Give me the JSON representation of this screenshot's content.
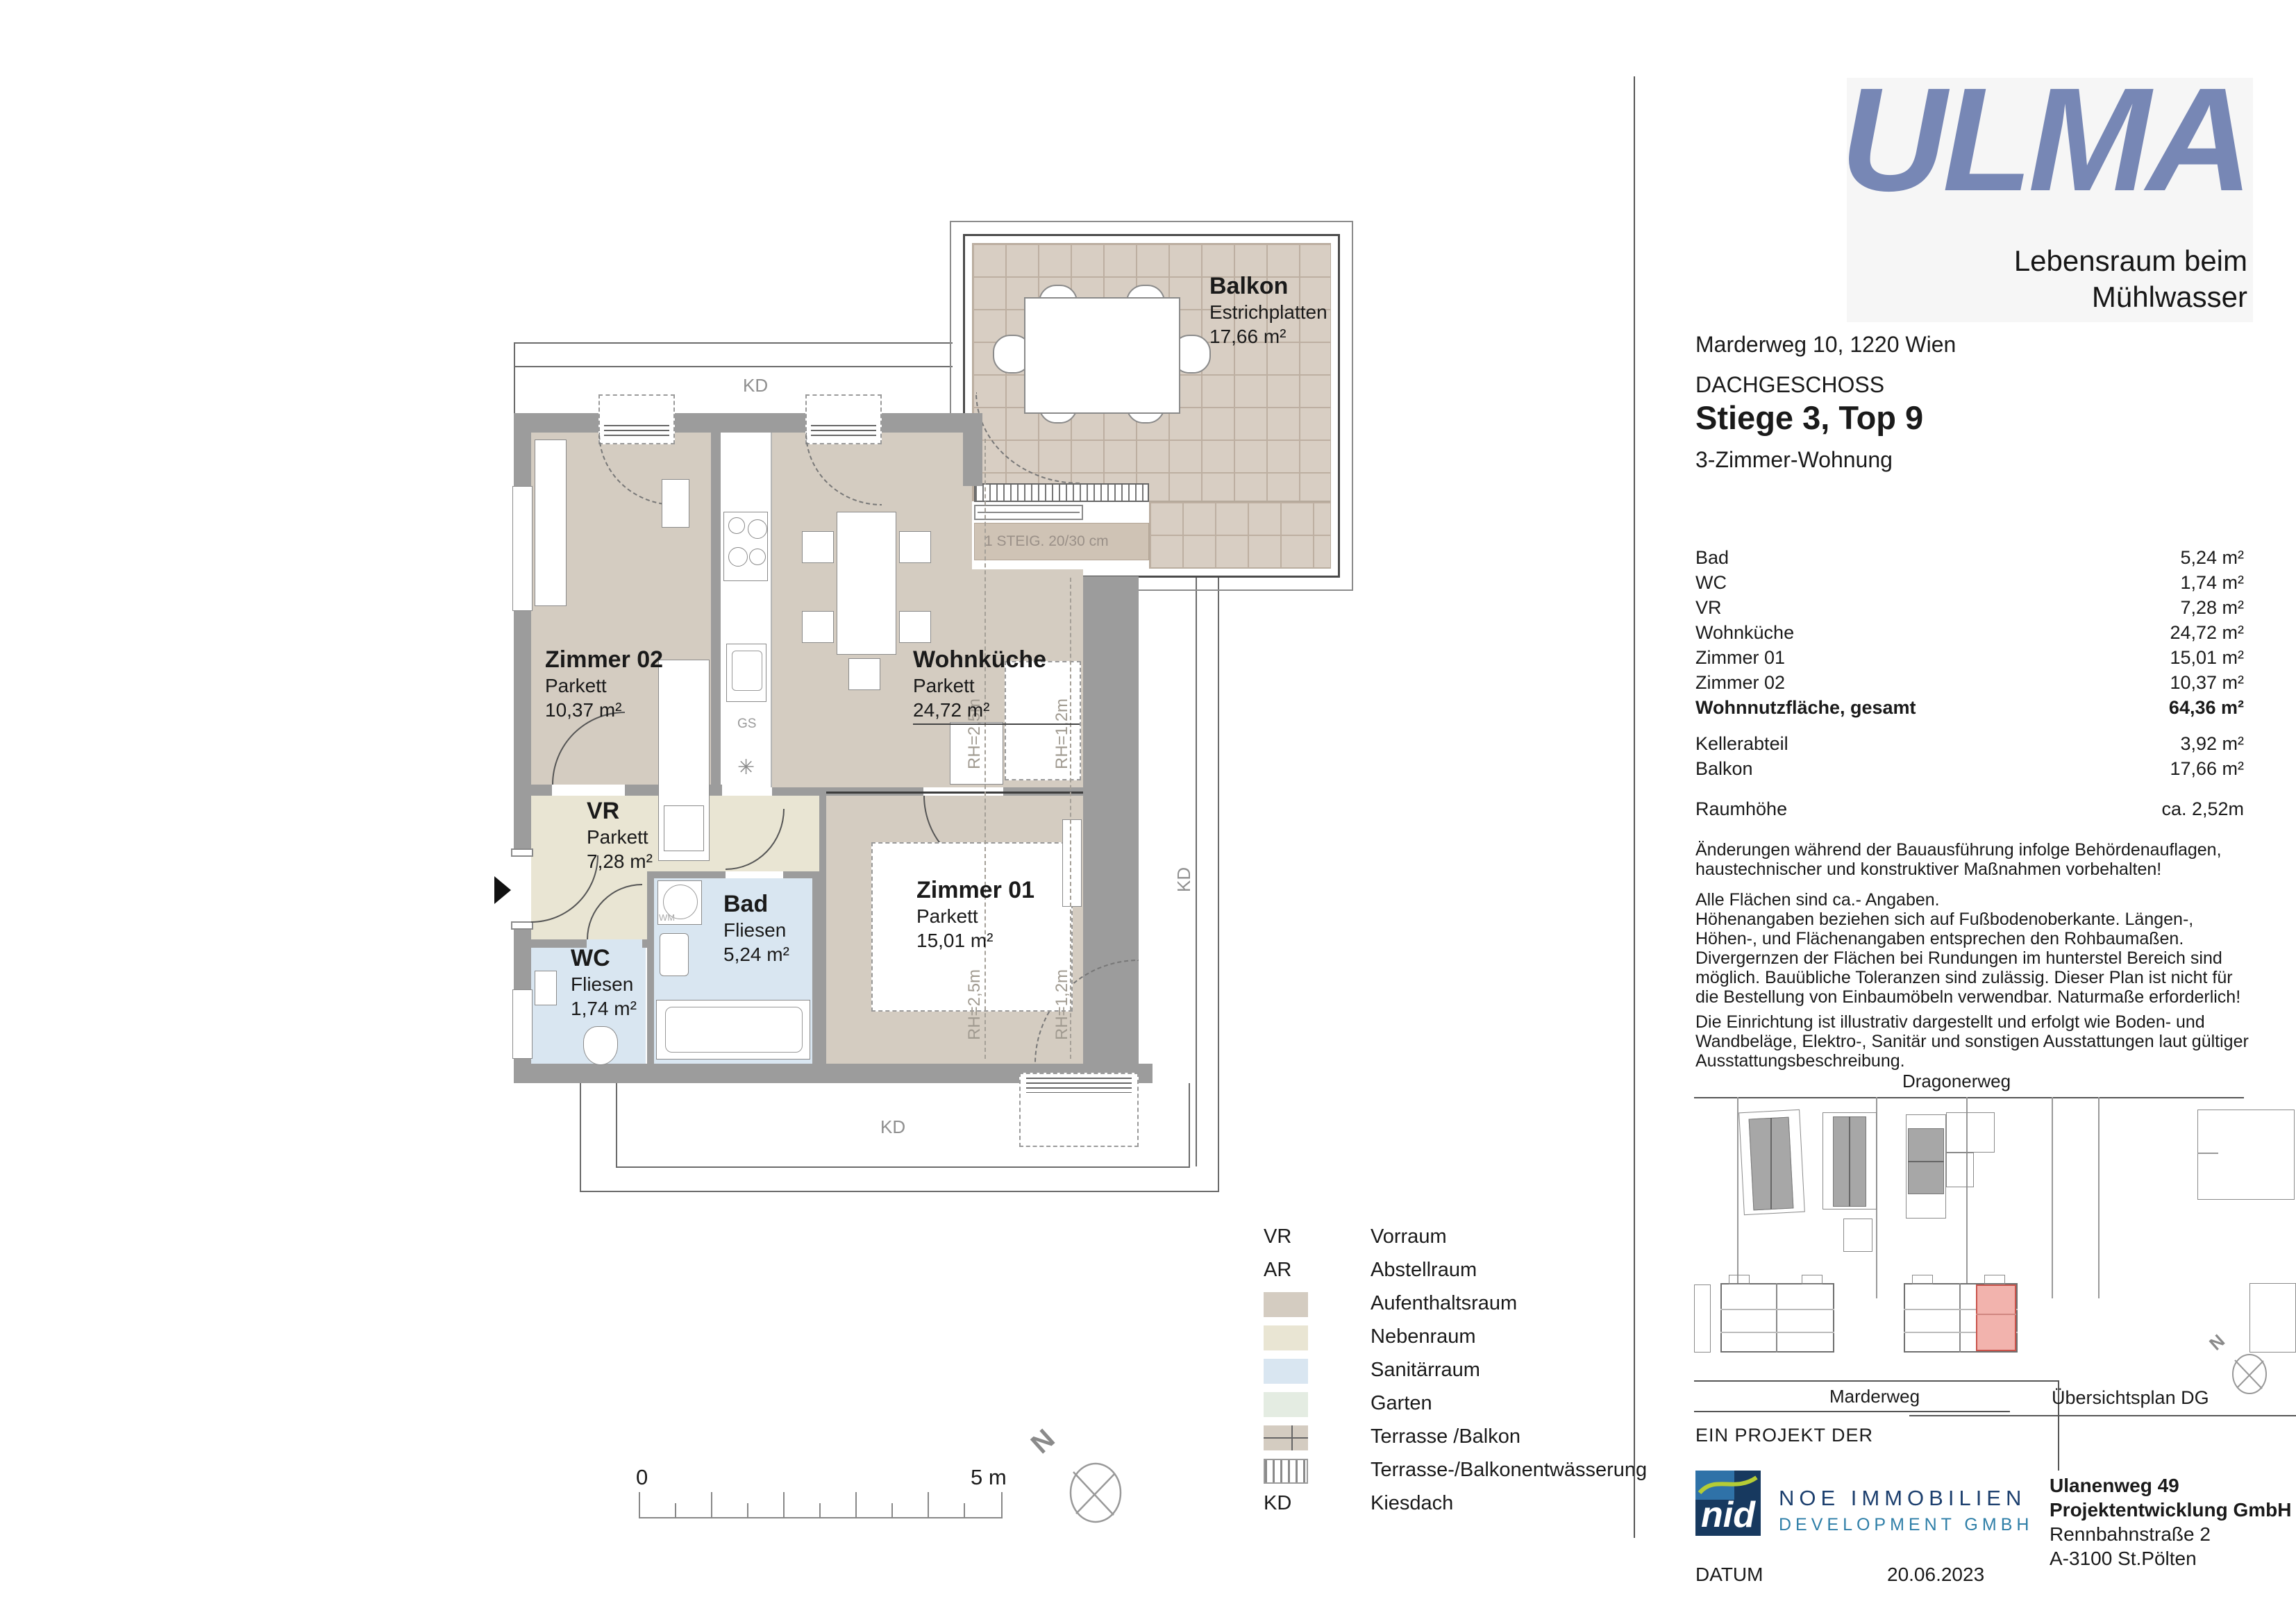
{
  "header": {
    "logo_text": "ULMA",
    "tagline_line1": "Lebensraum beim",
    "tagline_line2": "Mühlwasser",
    "address": "Marderweg 10, 1220 Wien",
    "floor": "DACHGESCHOSS",
    "unit": "Stiege 3, Top 9",
    "apartment_type": "3-Zimmer-Wohnung"
  },
  "area_table": {
    "rows": [
      {
        "label": "Bad",
        "value": "5,24 m²"
      },
      {
        "label": "WC",
        "value": "1,74 m²"
      },
      {
        "label": "VR",
        "value": "7,28 m²"
      },
      {
        "label": "Wohnküche",
        "value": "24,72 m²"
      },
      {
        "label": "Zimmer 01",
        "value": "15,01 m²"
      },
      {
        "label": "Zimmer 02",
        "value": "10,37 m²"
      },
      {
        "label": "Wohnnutzfläche, gesamt",
        "value": "64,36 m²"
      }
    ],
    "extra_rows": [
      {
        "label": "Kellerabteil",
        "value": "3,92 m²"
      },
      {
        "label": "Balkon",
        "value": "17,66 m²"
      }
    ],
    "room_height": {
      "label": "Raumhöhe",
      "value": "ca. 2,52m"
    }
  },
  "disclaimers": [
    "Änderungen während der Bauausführung infolge Behördenauflagen, haustechnischer und konstruktiver Maßnahmen vorbehalten!",
    "Alle Flächen sind ca.- Angaben.\nHöhenangaben beziehen sich auf Fußbodenoberkante. Längen-, Höhen-, und Flächenangaben entsprechen den Rohbaumaßen. Divergernzen der Flächen bei Rundungen im hunterstel Bereich sind möglich. Bauübliche Toleranzen sind zulässig. Dieser Plan ist nicht für die Bestellung von Einbaumöbeln verwendbar. Naturmaße erforderlich!",
    "Die Einrichtung ist illustrativ dargestellt und erfolgt wie Boden- und Wandbeläge, Elektro-, Sanitär und sonstigen Ausstattungen laut gültiger Ausstattungsbeschreibung."
  ],
  "floorplan": {
    "rooms": {
      "zimmer02": {
        "name": "Zimmer 02",
        "finish": "Parkett",
        "area": "10,37 m²"
      },
      "wohnkueche": {
        "name": "Wohnküche",
        "finish": "Parkett",
        "area": "24,72 m²"
      },
      "vr": {
        "name": "VR",
        "finish": "Parkett",
        "area": "7,28 m²"
      },
      "bad": {
        "name": "Bad",
        "finish": "Fliesen",
        "area": "5,24 m²"
      },
      "wc": {
        "name": "WC",
        "finish": "Fliesen",
        "area": "1,74 m²"
      },
      "zimmer01": {
        "name": "Zimmer 01",
        "finish": "Parkett",
        "area": "15,01 m²"
      },
      "balkon": {
        "name": "Balkon",
        "finish": "Estrichplatten",
        "area": "17,66 m²"
      }
    },
    "annotations": {
      "kd_top": "KD",
      "kd_bottom": "KD",
      "kd_right": "KD",
      "steig": "1 STEIG. 20/30 cm",
      "gs": "GS",
      "rh_25": "RH=2,5m",
      "rh_12": "RH=1,2m",
      "wm": "WM"
    }
  },
  "legend": {
    "items": [
      {
        "key": "VR",
        "label": "Vorraum"
      },
      {
        "key": "AR",
        "label": "Abstellraum"
      },
      {
        "key": "",
        "label": "Aufenthaltsraum"
      },
      {
        "key": "",
        "label": "Nebenraum"
      },
      {
        "key": "",
        "label": "Sanitärraum"
      },
      {
        "key": "",
        "label": "Garten"
      },
      {
        "key": "",
        "label": "Terrasse /Balkon"
      },
      {
        "key": "",
        "label": "Terrasse-/Balkonentwässerung"
      },
      {
        "key": "KD",
        "label": "Kiesdach"
      }
    ]
  },
  "scale_bar": {
    "start": "0",
    "end": "5 m"
  },
  "compass": {
    "north": "N"
  },
  "site_plan": {
    "street_top": "Dragonerweg",
    "street_bottom": "Marderweg",
    "caption": "Übersichtsplan DG",
    "north": "N"
  },
  "footer": {
    "project_label": "EIN PROJEKT DER",
    "nid_logo_text": "nid",
    "noe_line1": "NOE IMMOBILIEN",
    "noe_line2": "DEVELOPMENT GMBH",
    "company_lines": [
      "Ulanenweg 49",
      "Projektentwicklung GmbH",
      "Rennbahnstraße 2",
      "A-3100 St.Pölten"
    ],
    "datum_label": "DATUM",
    "datum_value": "20.06.2023"
  },
  "colors": {
    "aufenthaltsraum": "#d4ccc1",
    "nebenraum": "#e9e5d3",
    "sanitaerraum": "#d9e6f1",
    "garten": "#e4ece2",
    "wall_gray": "#9c9c9c",
    "ulma_blue": "#7787b5",
    "nid_navy": "#17395f",
    "nid_light_blue": "#2f72a8",
    "nid_green": "#b5cc35",
    "noe_blue": "#2f7fa8",
    "highlight_red": "#f2b3ad"
  }
}
